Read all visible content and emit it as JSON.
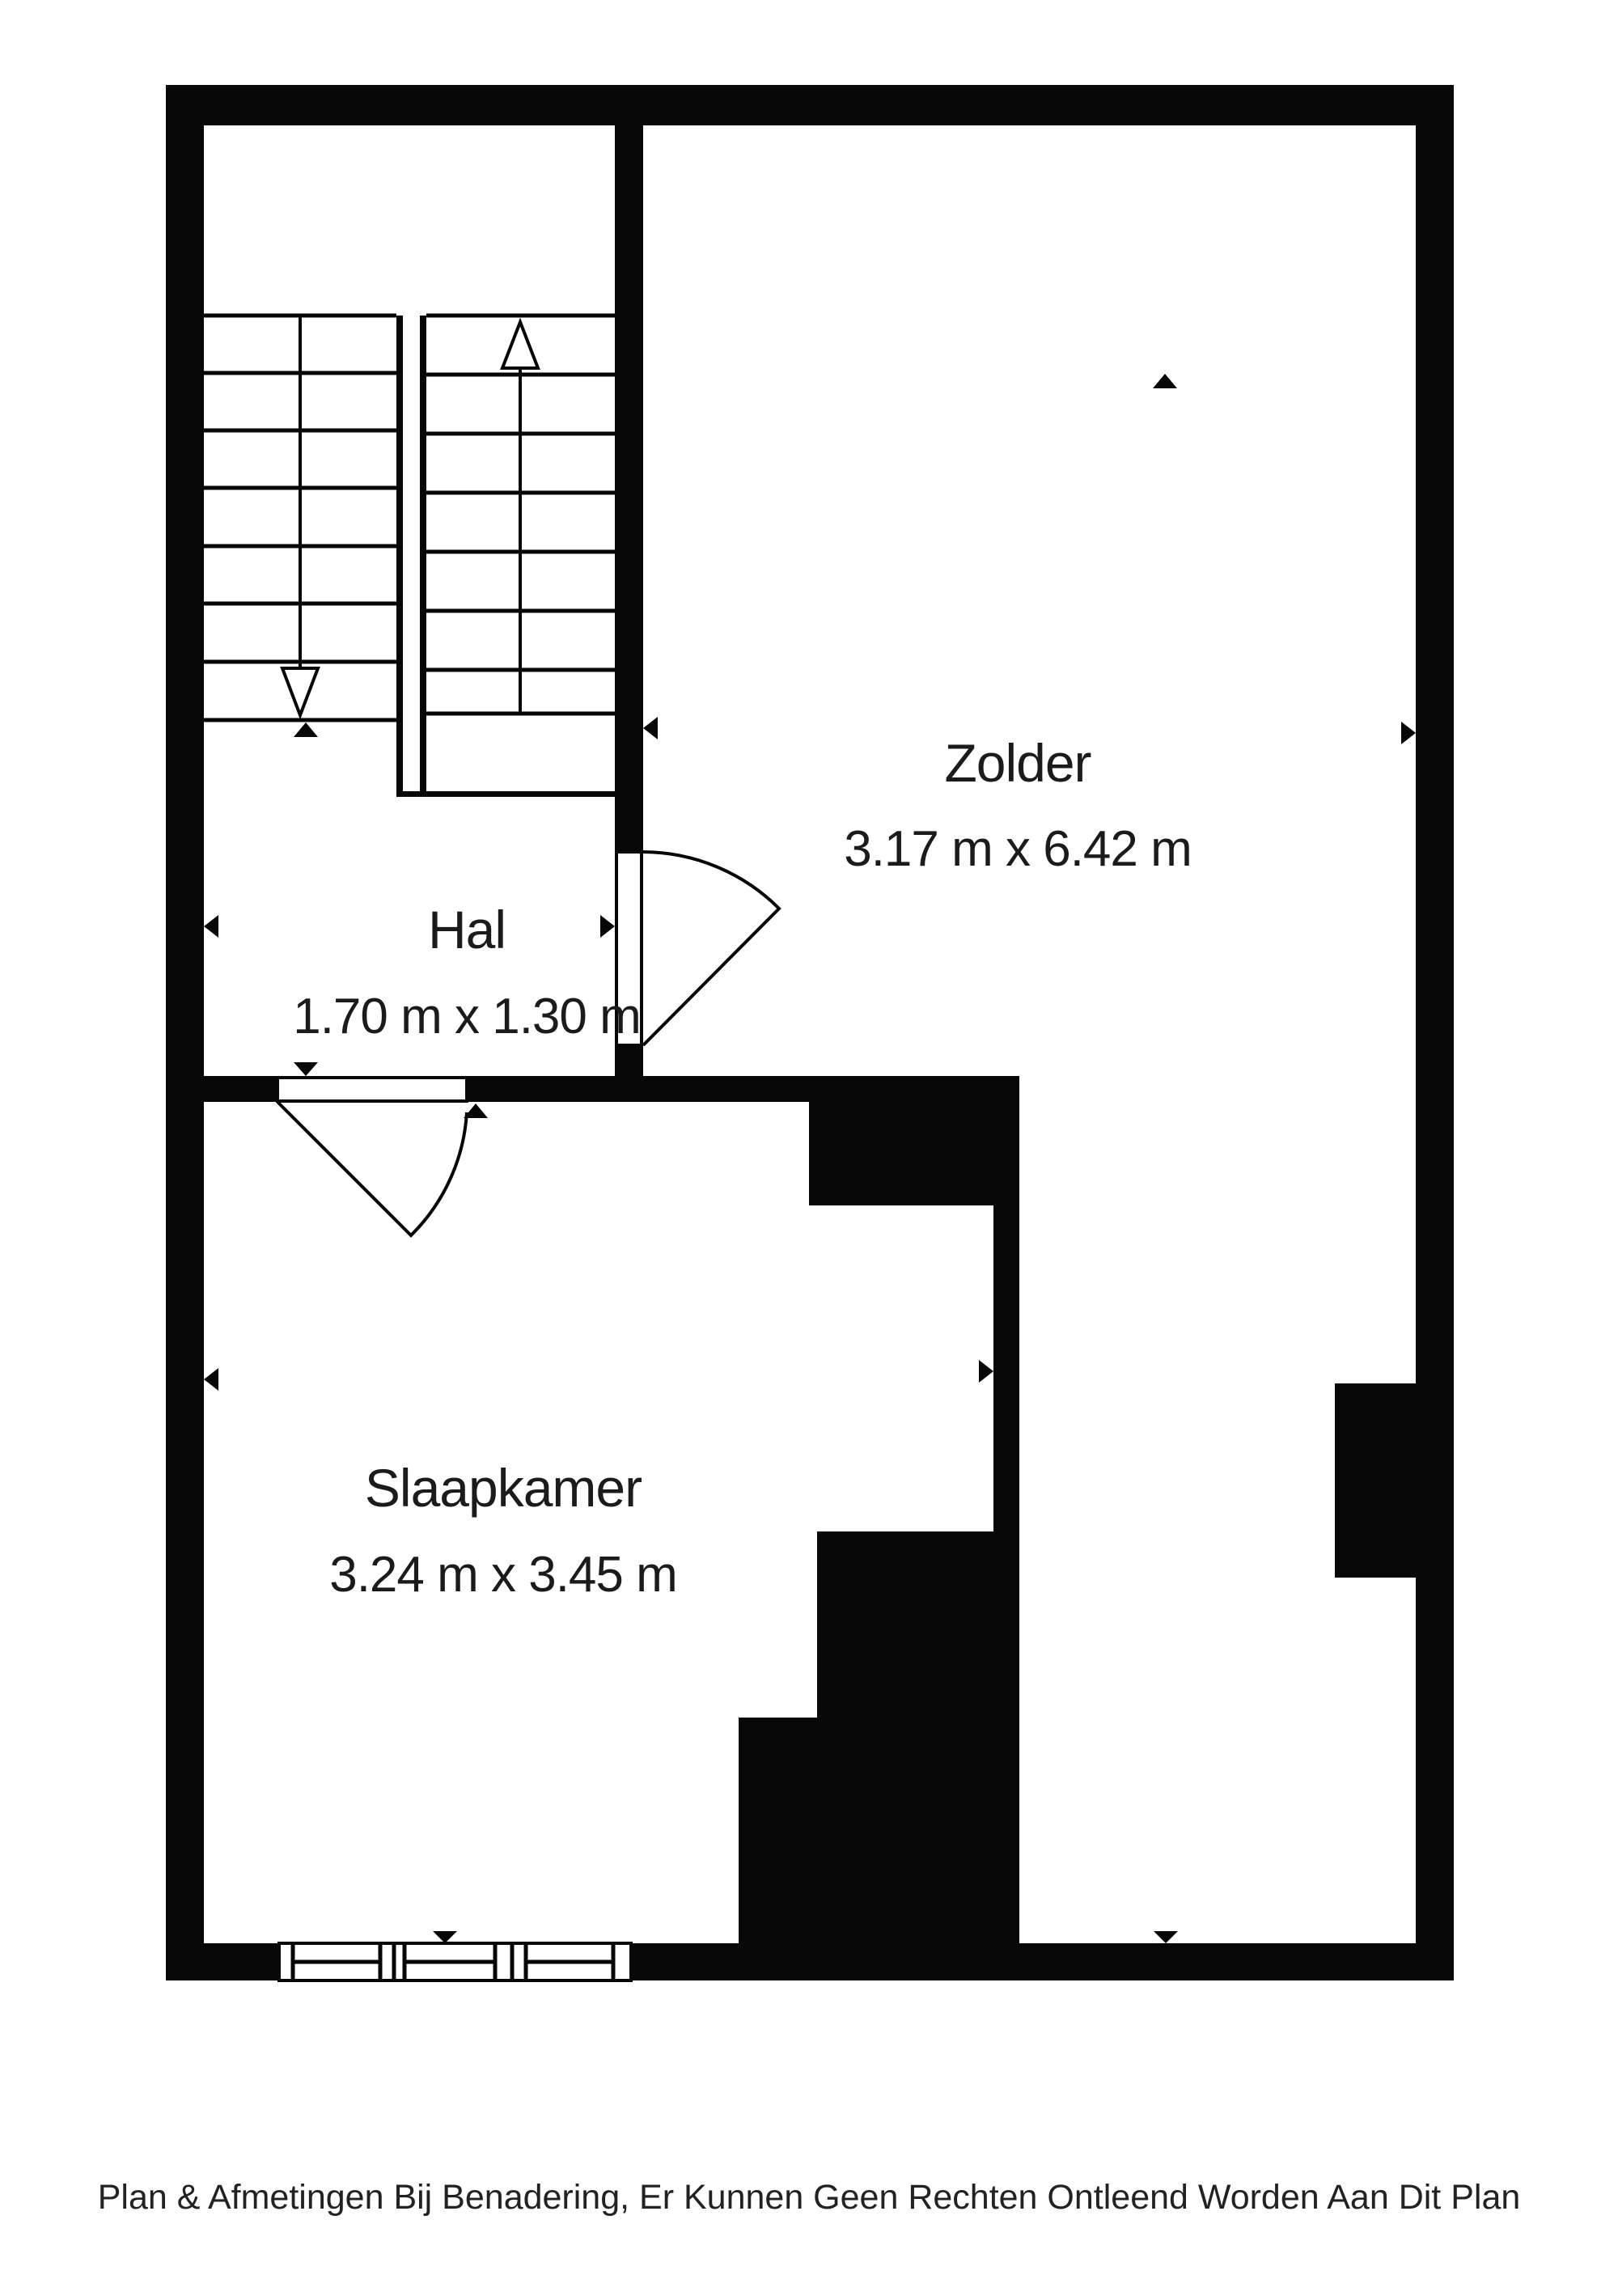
{
  "page": {
    "background_color": "#ffffff",
    "wall_color": "#070707",
    "text_color": "#1b1b1b"
  },
  "rooms": {
    "zolder": {
      "name": "Zolder",
      "dims": "3.17 m x 6.42 m"
    },
    "hal": {
      "name": "Hal",
      "dims": "1.70 m x 1.30 m"
    },
    "slaapkamer": {
      "name": "Slaapkamer",
      "dims": "3.24 m x 3.45 m"
    }
  },
  "footer": {
    "disclaimer": "Plan & Afmetingen Bij Benadering, Er Kunnen Geen Rechten Ontleend Worden Aan Dit Plan"
  }
}
